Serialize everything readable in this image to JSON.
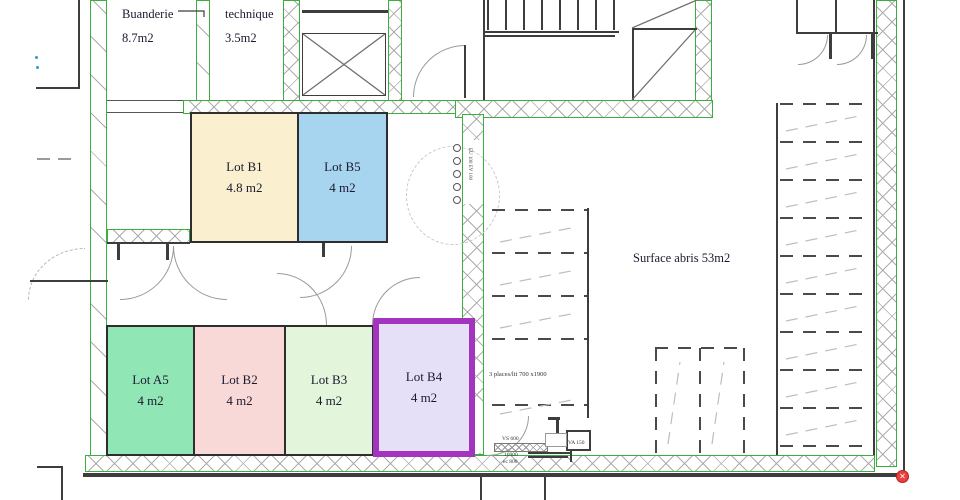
{
  "rooms": {
    "buanderie": {
      "name": "Buanderie",
      "area": "8.7m2"
    },
    "technique": {
      "name": "technique",
      "area": "3.5m2"
    }
  },
  "lots": [
    {
      "id": "B1",
      "label": "Lot B1",
      "area": "4.8 m2",
      "fill": "#FAF0CF"
    },
    {
      "id": "B5",
      "label": "Lot B5",
      "area": "4 m2",
      "fill": "#A7D4EE"
    },
    {
      "id": "A5",
      "label": "Lot A5",
      "area": "4 m2",
      "fill": "#90E6B5"
    },
    {
      "id": "B2",
      "label": "Lot B2",
      "area": "4 m2",
      "fill": "#F9D8D8"
    },
    {
      "id": "B3",
      "label": "Lot B3",
      "area": "4 m2",
      "fill": "#E3F6DB"
    },
    {
      "id": "B4",
      "label": "Lot B4",
      "area": "4 m2",
      "fill": "#E5DFF8",
      "highlight_border": "#A234BE"
    }
  ],
  "annotations": {
    "surface_abris": "Surface abris 53m2",
    "bike_places": "3 places/lit 700 x1900",
    "vs": "VS 600",
    "dim1": "10000",
    "dim2": "ec 800",
    "va": "VA 150",
    "riser": "EU 100 EV 100",
    "marker": "✕"
  },
  "colors": {
    "wall_outline": "#3CAE3C",
    "hatch": "#ACACAC",
    "line": "#3D3D3D",
    "highlight": "#A234BE",
    "marker": "#E8403C"
  }
}
